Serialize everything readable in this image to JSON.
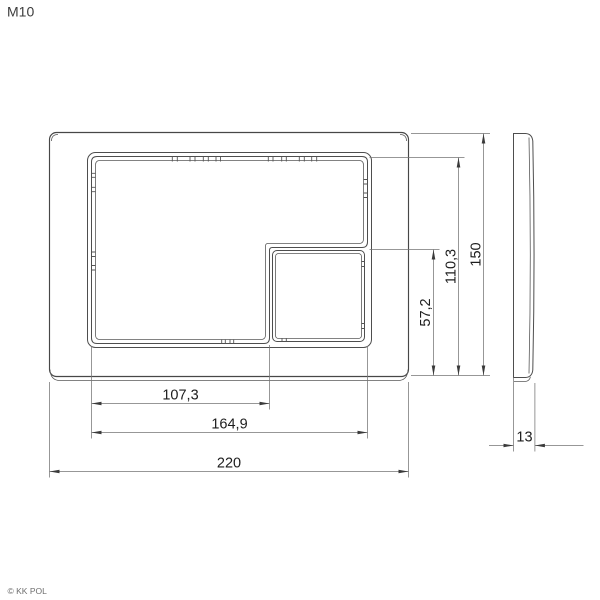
{
  "page": {
    "title": "M10",
    "copyright": "© KK POL"
  },
  "drawing": {
    "type": "technical-drawing",
    "subject": "flush-plate",
    "views": [
      "front",
      "side"
    ],
    "units_implied": "mm",
    "dimensions": {
      "big_button_width": "107,3",
      "buttons_width": "164,9",
      "total_width": "220",
      "small_button_height": "57,2",
      "buttons_height": "110,3",
      "total_height": "150",
      "thickness": "13"
    }
  }
}
